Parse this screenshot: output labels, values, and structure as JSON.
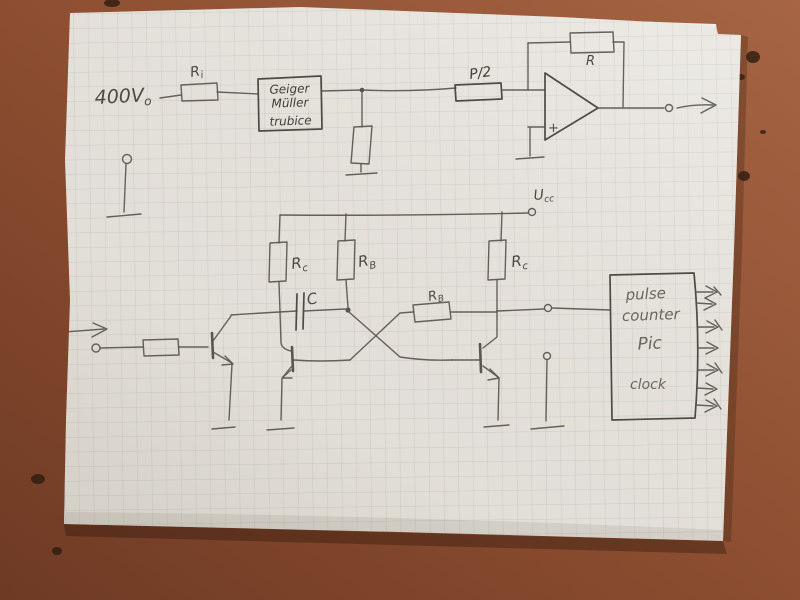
{
  "sketch": {
    "supply_label": {
      "main": "400V",
      "sub": "o"
    },
    "input_resistor": {
      "main": "R",
      "sub": "i"
    },
    "gm_tube_box": {
      "line1": "Geiger",
      "line2": "Müller",
      "line3": "trubice"
    },
    "divider_resistor_label": "P/2",
    "feedback_resistor_label": "R",
    "opamp_noninverting_label": "+",
    "supply_rail": {
      "main": "U",
      "sub": "cc"
    },
    "rc_left": {
      "main": "R",
      "sub": "c"
    },
    "rb_upper": {
      "main": "R",
      "sub": "B"
    },
    "rc_right": {
      "main": "R",
      "sub": "c"
    },
    "capacitor_label": "C",
    "rb_coupling": {
      "main": "R",
      "sub": "B"
    },
    "counter_box": {
      "line1": "pulse",
      "line2": "counter",
      "line3": "Pic",
      "line4": "clock"
    }
  },
  "colors": {
    "table": "#8f5134",
    "paper": "#e8e5de",
    "grid_line": "#b6bdc2",
    "pencil": "#55524a"
  }
}
